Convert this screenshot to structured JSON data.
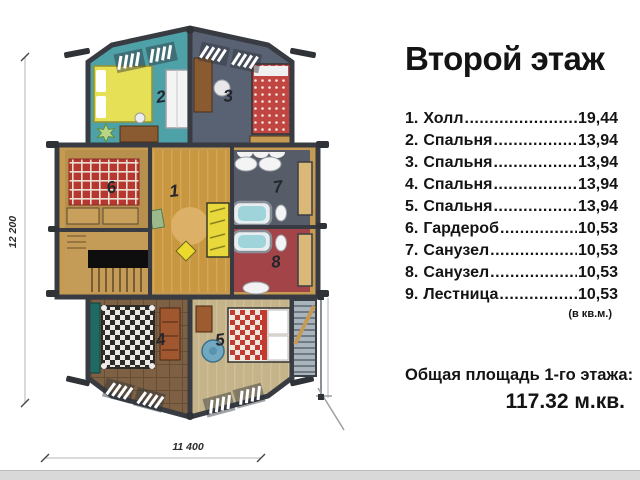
{
  "title": "Второй этаж",
  "legend": {
    "leader": "......................................................................",
    "units_note": "(в кв.м.)",
    "items": [
      {
        "num": "1.",
        "label": "Холл",
        "value": "19,44"
      },
      {
        "num": "2.",
        "label": "Спальня",
        "value": "13,94"
      },
      {
        "num": "3.",
        "label": "Спальня",
        "value": "13,94"
      },
      {
        "num": "4.",
        "label": "Спальня",
        "value": "13,94"
      },
      {
        "num": "5.",
        "label": "Спальня",
        "value": "13,94"
      },
      {
        "num": "6.",
        "label": "Гардероб",
        "value": "10,53"
      },
      {
        "num": "7.",
        "label": "Санузел",
        "value": "10,53"
      },
      {
        "num": "8.",
        "label": "Санузел",
        "value": "10,53"
      },
      {
        "num": "9.",
        "label": "Лестница",
        "value": "10,53"
      }
    ]
  },
  "total": {
    "label": "Общая площадь 1-го этажа:",
    "value": "117.32 м.кв."
  },
  "plan": {
    "dim_height": "12 200",
    "dim_width": "11 400",
    "rooms": {
      "r1": "1",
      "r2": "2",
      "r3": "3",
      "r4": "4",
      "r5": "5",
      "r6": "6",
      "r7": "7",
      "r8": "8"
    }
  },
  "colors": {
    "wall": "#383c42",
    "log_wood": "#c59a52",
    "room1_hall": "#c8973f",
    "room2_bedroom": "#4fa1a8",
    "room3_bedroom": "#596273",
    "room4_bedroom": "#7e6144",
    "room5_bedroom": "#c5b389",
    "room6_wardrobe": "#b8904e",
    "room7_bath": "#565c68",
    "room8_bath": "#a34449",
    "bed_yellow": "#e6e057",
    "bed_red": "#c14541",
    "water": "#9fd4da",
    "bottom_strip": "#d9d9d9"
  }
}
